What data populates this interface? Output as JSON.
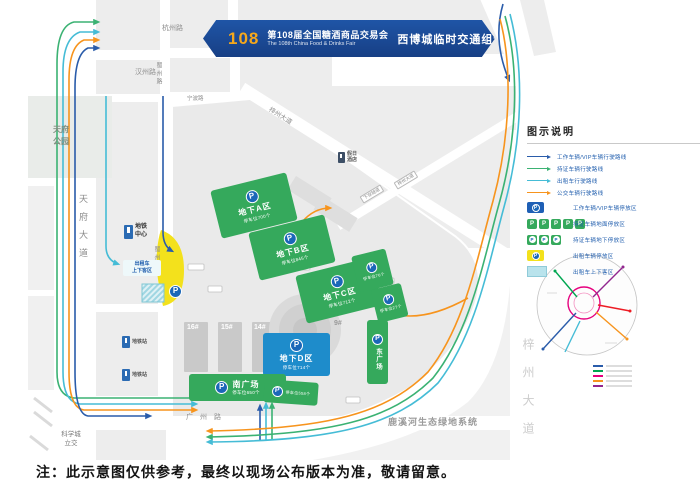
{
  "banner": {
    "number": "108",
    "title_cn": "第108届全国糖酒商品交易会",
    "title_en": "The 108th China Food & Drinks Fair",
    "subtitle": "西博城临时交通组织示意图"
  },
  "legend": {
    "title": "图示说明",
    "routes": [
      {
        "label": "工作车辆/VIP车辆行驶路线",
        "color": "#2a5caa"
      },
      {
        "label": "持证车辆行驶路线",
        "color": "#3bb273"
      },
      {
        "label": "出租车行驶路线",
        "color": "#45bcd6"
      },
      {
        "label": "公交车辆行驶路线",
        "color": "#f7941d"
      }
    ],
    "badges": [
      {
        "label": "工作车辆/VIP车辆停放区",
        "style": "blue-p"
      },
      {
        "label": "持证车辆地面停放区",
        "style": "green-p-x5"
      },
      {
        "label": "持证车辆地下停放区",
        "style": "green-p-x3"
      },
      {
        "label": "出租车辆停放区",
        "style": "yellow-p"
      },
      {
        "label": "出租车上下客区",
        "style": "cyan-rect"
      }
    ]
  },
  "map": {
    "roads": {
      "hangzhou": "杭州路",
      "hanzhou": "汉州路",
      "ningbo": "宁波路",
      "shuzhou_n": "蜀州路",
      "shuzhou_s": "蜀州路",
      "tianfu": "天府大道",
      "zizhou_diag": "梓州大道",
      "tunnel": "下穿隧道",
      "zizhou_chip": "梓州大道",
      "guangzhou": "广州路",
      "zizhou_e": "梓州大道"
    },
    "areas": {
      "park_l1": "天府",
      "park_l2": "公园",
      "kexuecheng_l1": "科学城",
      "kexuecheng_l2": "立交",
      "luxihe": "鹿溪河生态绿地系统"
    },
    "pois": {
      "metro_center_l1": "地铁",
      "metro_center_l2": "中心",
      "taxi_l1": "出租车",
      "taxi_l2": "上下客区",
      "metro_a": "地铁站",
      "metro_b": "地铁站",
      "hotel_l1": "假日",
      "hotel_l2": "酒店"
    },
    "zones": [
      {
        "name": "地下A区",
        "sub": "停车位700个"
      },
      {
        "name": "地下B区",
        "sub": "停车位845个"
      },
      {
        "name": "地下C区",
        "sub": "停车位712个"
      },
      {
        "name": "地下D区",
        "sub": "停车位714个"
      },
      {
        "name": "南广场",
        "sub": "停车位650个"
      },
      {
        "sub": "停车位76个"
      },
      {
        "sub": "停车位27个"
      },
      {
        "name": "东广场"
      },
      {
        "sub": "停车位558个"
      }
    ],
    "halls": [
      "16#",
      "15#",
      "14#",
      "9#"
    ]
  },
  "symbols": {
    "p": "P"
  },
  "note": "注：此示意图仅供参考，最终以现场公布版本为准，敬请留意。"
}
